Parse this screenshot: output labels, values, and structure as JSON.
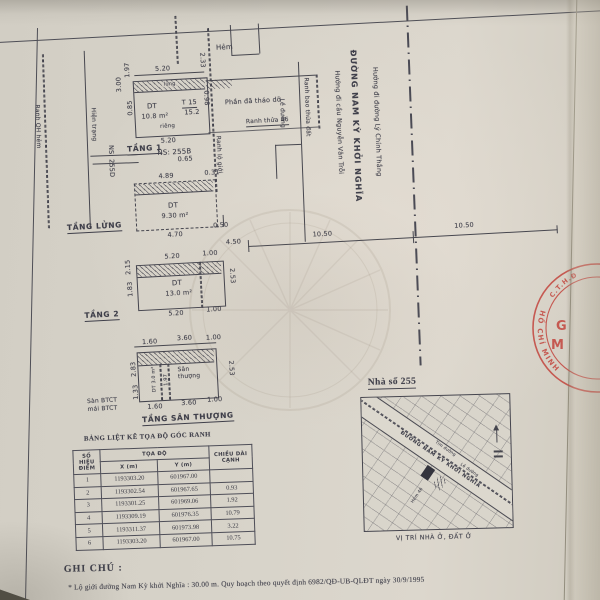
{
  "doc": {
    "colors": {
      "ink": "#3e3e49",
      "paper": "#d7d3c9",
      "stamp_red": "#c23f38"
    },
    "floor1": {
      "label": "TẦNG 1",
      "hem": "Hẻm",
      "dt": "DT",
      "area": "10.8 m²",
      "t_num": "T 15",
      "t_den": "15.2",
      "strip": "lửng",
      "rieng": "riêng",
      "dim_top": "5.20",
      "dim_bottom": "5.20",
      "ns": "NS: 255B",
      "d197": "1.97",
      "d300": "3.00",
      "d085": "0.85",
      "d233": "2.33",
      "d098": "0.98",
      "demolished": "Phần đã tháo dỡ",
      "ranh_thua": "Ranh thửa 46",
      "ranh_lo_gioi": "Ranh lộ giới"
    },
    "alley": {
      "ranh_qh": "Ranh QH hẻm",
      "hien_trang": "Hiện trạng",
      "ns": "NS: 255D"
    },
    "street": {
      "le_duong": "Lề đường",
      "ranh_bao": "Ranh bao thửa đất",
      "dir_nvt": "Hướng đi cầu Nguyễn Văn Trỗi",
      "name": "ĐƯỜNG NAM KỲ KHỞI NGHĨA",
      "dir_lct": "Hướng đi đường Lý Chính Thắng"
    },
    "mezzanine": {
      "label": "TẦNG LỬNG",
      "dt": "DT",
      "area": "9.30 m²",
      "d065": "0.65",
      "d489": "4.89",
      "d031": "0.31",
      "d470": "4.70",
      "d050": "0.50"
    },
    "dimrow": {
      "d520": "5.20",
      "d100": "1.00",
      "d450": "4.50",
      "d1050_left": "10.50",
      "d1050_right": "10.50"
    },
    "floor2": {
      "label": "TẦNG 2",
      "dt": "DT",
      "area": "13.0 m²",
      "dim_bottom": "5.20",
      "d100": "1.00",
      "d215": "2.15",
      "d183": "1.83",
      "d253": "2.53"
    },
    "roof": {
      "label": "TẦNG SÂN THƯỢNG",
      "san": "Sân thượng",
      "dt_area": "DT 3.0 m²",
      "d197": "1.97",
      "t160": "1.60",
      "t360": "3.60",
      "t100": "1.00",
      "b160": "1.60",
      "b360": "3.60",
      "b100": "1.00",
      "d283": "2.83",
      "d133": "1.33",
      "d253": "2.53",
      "btct1": "Sàn BTCT",
      "btct2": "mái BTCT"
    },
    "table": {
      "title": "BẢNG LIỆT KÊ TỌA ĐỘ GÓC RANH",
      "h_so_hieu": "SỐ HIỆU",
      "h_diem": "ĐIỂM",
      "h_toa_do": "TỌA ĐỘ",
      "h_x": "X (m)",
      "h_y": "Y (m)",
      "h_chieu_dai": "CHIỀU DÀI",
      "h_canh": "CẠNH",
      "rows": [
        {
          "n": "1",
          "x": "1193303.20",
          "y": "601967.00",
          "d": ""
        },
        {
          "n": "2",
          "x": "1193302.54",
          "y": "601967.65",
          "d": "0.93"
        },
        {
          "n": "3",
          "x": "1193301.25",
          "y": "601969.06",
          "d": "1.92"
        },
        {
          "n": "4",
          "x": "1193309.19",
          "y": "601976.35",
          "d": "10.79"
        },
        {
          "n": "5",
          "x": "1193311.37",
          "y": "601973.98",
          "d": "3.22"
        },
        {
          "n": "6",
          "x": "1193303.20",
          "y": "601967.00",
          "d": "10.75"
        }
      ]
    },
    "map": {
      "title": "Nhà số 255",
      "caption": "VỊ TRÍ NHÀ Ở, ĐẤT Ở",
      "tim_duong": "Tim đường",
      "street": "ĐƯỜNG NAM KỲ KHỞI NGHĨA",
      "le_duong": "Lề đường",
      "hem": "Hẻm 46"
    },
    "stamp": {
      "arc_top": "C.T.H.Đ",
      "arc_bottom": "HỒ CHÍ MINH",
      "g": "G",
      "m": "M"
    },
    "notes": {
      "title": "GHI CHÚ :",
      "line": "* Lộ giới đường Nam Kỳ khởi Nghĩa : 30.00 m. Quy hoạch theo quyết định 6982/QĐ-UB-QLĐT ngày 30/9/1995"
    }
  }
}
